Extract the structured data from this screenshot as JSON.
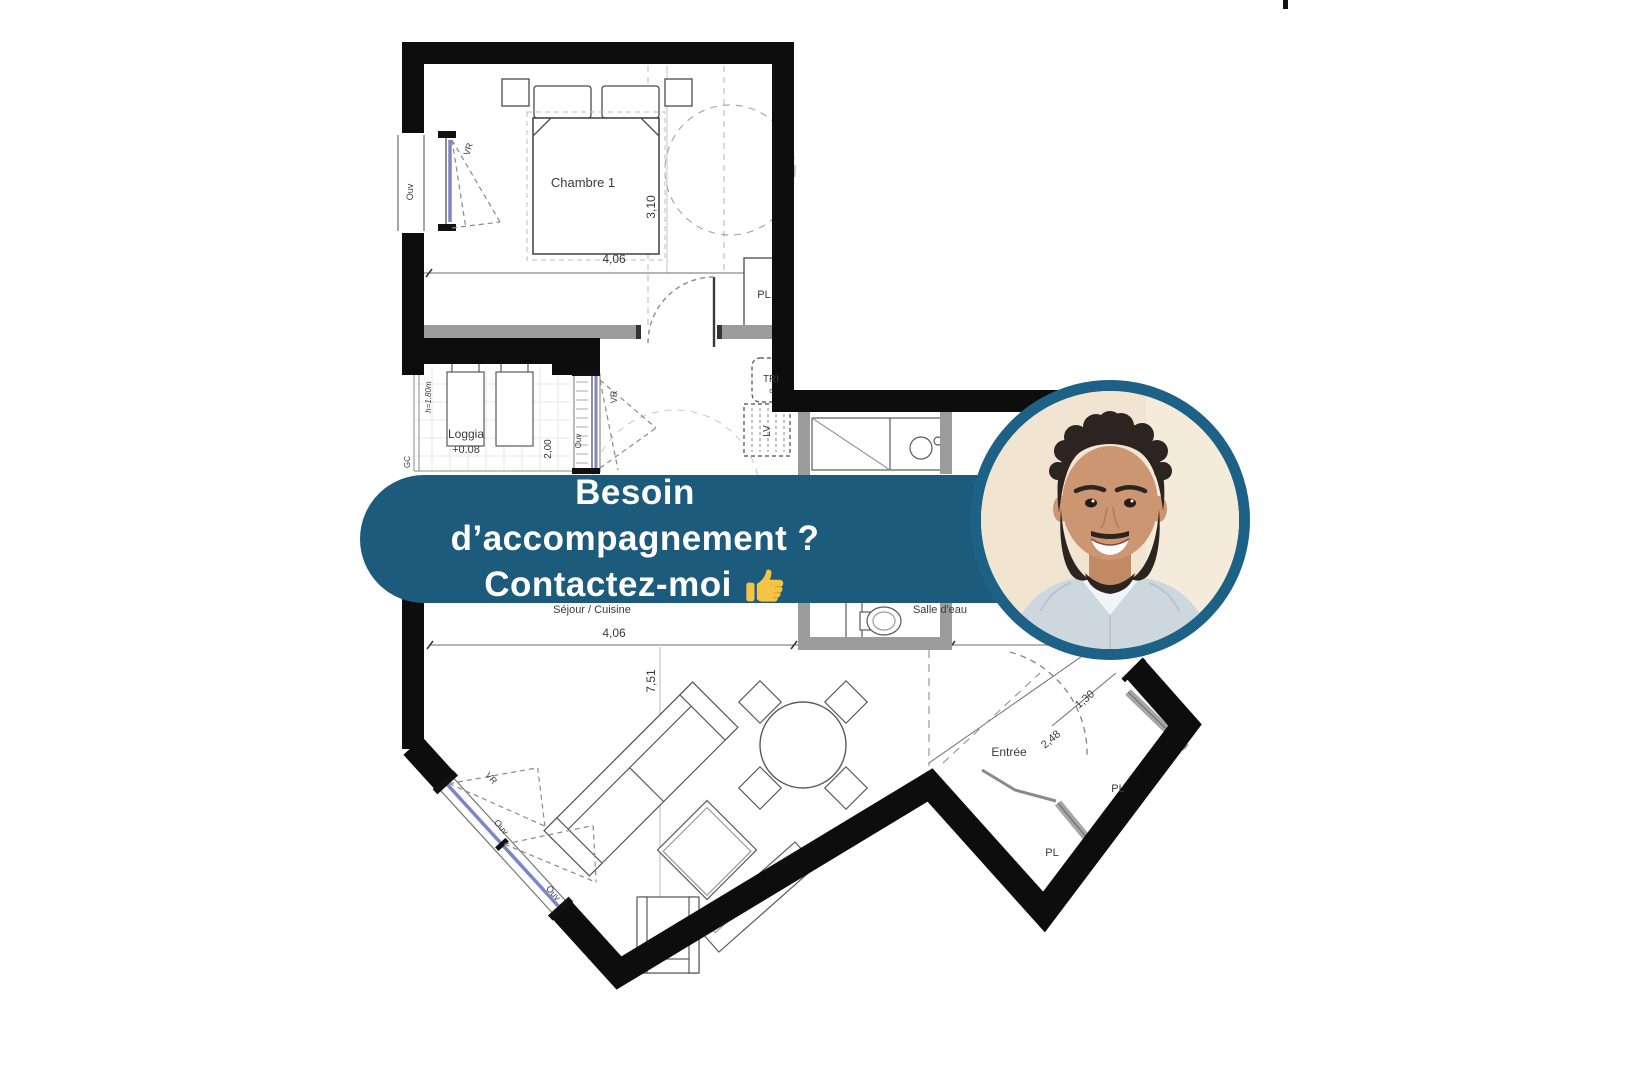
{
  "page": {
    "background": "#ffffff"
  },
  "banner": {
    "line1": "Besoin d’accompagnement ?",
    "line2": "Contactez-moi",
    "thumb_icon": "thumbs-up",
    "bg_color": "#1d5b7d",
    "text_color": "#ffffff"
  },
  "advisor_photo": {
    "description": "Smiling advisor with dark curly hair, short beard and light blue shirt",
    "ring_color": "#1d6286",
    "background_color": "#f1e5d2"
  },
  "floor_plan": {
    "rooms": {
      "bedroom": {
        "label": "Chambre 1",
        "width": "4,06",
        "depth": "3,10"
      },
      "loggia": {
        "label": "Loggia",
        "level": "+0.08",
        "width": "2,00",
        "rail_height": "h=1.80m"
      },
      "living": {
        "label": "Séjour / Cuisine",
        "width": "4,06",
        "depth": "7,51"
      },
      "bathroom": {
        "label": "Salle d'eau"
      },
      "entry": {
        "label": "Entrée",
        "dim1": "2,48",
        "dim2": "1,30"
      }
    },
    "closets": {
      "pl1": "PL",
      "pl2": "PL",
      "pl3": "PL"
    },
    "appliances": {
      "tri": "TRI",
      "tri_sub": "c",
      "lv": "LV"
    },
    "windows": {
      "left_ouv": "Ouv",
      "left_vr": "VR",
      "loggia_ouv": "Ouv",
      "loggia_vr": "VR",
      "bottom_vr": "VR",
      "bottom_ouv1": "Ouv",
      "bottom_ouv2": "Ouv"
    },
    "misc": {
      "gc": "GC"
    }
  }
}
